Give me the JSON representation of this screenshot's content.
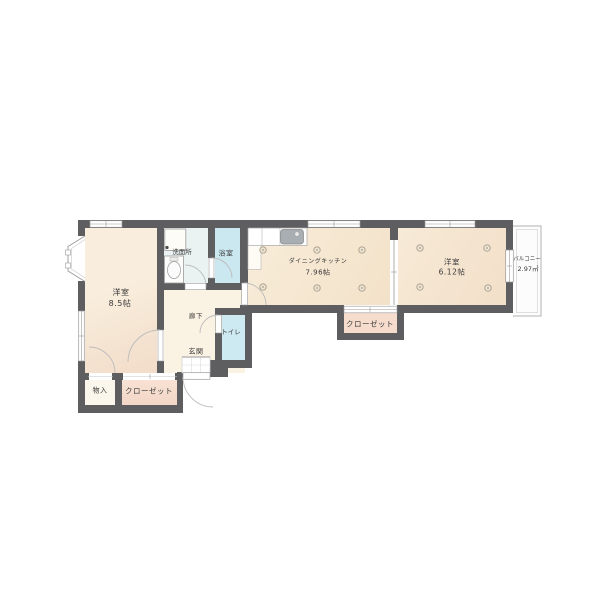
{
  "plan": {
    "rooms": {
      "bedroom_left": {
        "name": "洋室",
        "size": "8.5帖"
      },
      "dining_kitchen": {
        "name": "ダイニングキッチン",
        "size": "7.96帖"
      },
      "bedroom_right": {
        "name": "洋室",
        "size": "6.12帖"
      },
      "balcony": {
        "name": "バルコニー",
        "size": "2.97㎡"
      },
      "washroom": {
        "name": "洗面所"
      },
      "bathroom": {
        "name": "浴室"
      },
      "hallway": {
        "name": "廊下"
      },
      "toilet": {
        "name": "トイレ"
      },
      "entrance": {
        "name": "玄関"
      },
      "storage": {
        "name": "物入"
      },
      "closet_bedroom": {
        "name": "クローゼット"
      },
      "closet_hall": {
        "name": "クローゼット"
      }
    },
    "colors": {
      "wall": "#5e5e60",
      "floor_wood": "#f6e9d4",
      "floor_room_left": "#f7ebd9",
      "water_blue": "#cde8f1",
      "washroom_tint": "#eaf2f2",
      "closet_pink": "#f6dccd",
      "hall_cream": "#faf2e2",
      "balcony_white": "#fcfcfc",
      "line_gray": "#9a9a9a"
    }
  }
}
